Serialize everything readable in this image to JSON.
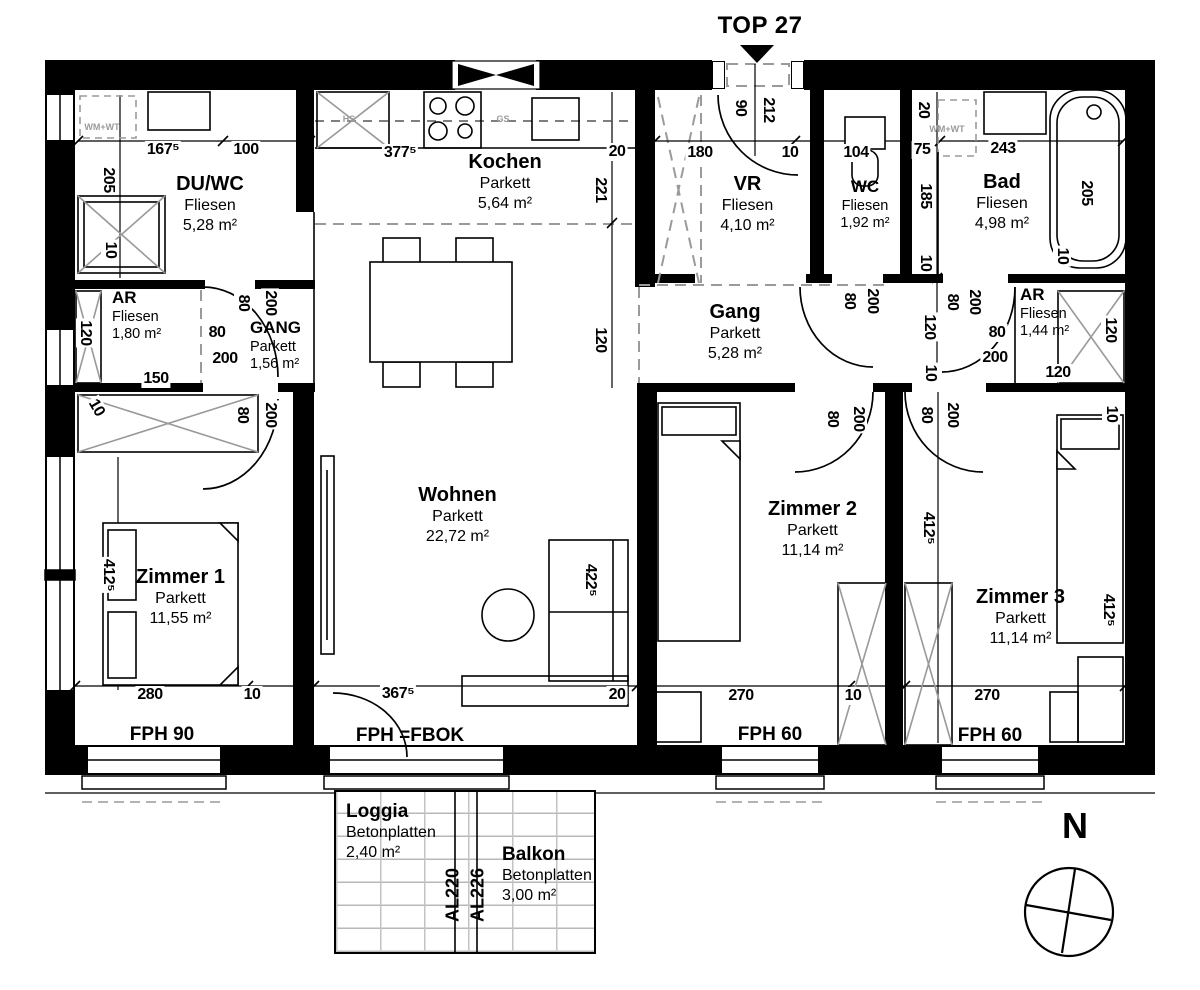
{
  "title": "TOP 27",
  "compass": {
    "label": "N"
  },
  "colors": {
    "wall": "#000000",
    "dash_gray": "#9a9a9a",
    "furniture_gray": "#999999"
  },
  "rooms": [
    {
      "name": "DU/WC",
      "floor": "Fliesen",
      "area": "5,28 m²"
    },
    {
      "name": "Kochen",
      "floor": "Parkett",
      "area": "5,64 m²"
    },
    {
      "name": "VR",
      "floor": "Fliesen",
      "area": "4,10 m²"
    },
    {
      "name": "WC",
      "floor": "Fliesen",
      "area": "1,92 m²"
    },
    {
      "name": "Bad",
      "floor": "Fliesen",
      "area": "4,98 m²"
    },
    {
      "name": "AR",
      "floor": "Fliesen",
      "area": "1,80 m²"
    },
    {
      "name": "GANG",
      "floor": "Parkett",
      "area": "1,56 m²"
    },
    {
      "name": "Gang",
      "floor": "Parkett",
      "area": "5,28 m²"
    },
    {
      "name": "AR",
      "floor": "Fliesen",
      "area": "1,44 m²"
    },
    {
      "name": "Wohnen",
      "floor": "Parkett",
      "area": "22,72 m²"
    },
    {
      "name": "Zimmer 1",
      "floor": "Parkett",
      "area": "11,55 m²"
    },
    {
      "name": "Zimmer 2",
      "floor": "Parkett",
      "area": "11,14 m²"
    },
    {
      "name": "Zimmer 3",
      "floor": "Parkett",
      "area": "11,14 m²"
    },
    {
      "name": "Loggia",
      "floor": "Betonplatten",
      "area": "2,40 m²"
    },
    {
      "name": "Balkon",
      "floor": "Betonplatten",
      "area": "3,00 m²"
    }
  ],
  "annotations": [
    {
      "t": "167⁵",
      "x": 163,
      "y": 150,
      "k": "dim"
    },
    {
      "t": "100",
      "x": 246,
      "y": 150,
      "k": "dim"
    },
    {
      "t": "377⁵",
      "x": 400,
      "y": 153,
      "k": "dim"
    },
    {
      "t": "20",
      "x": 617,
      "y": 152,
      "k": "dim"
    },
    {
      "t": "180",
      "x": 700,
      "y": 153,
      "k": "dim"
    },
    {
      "t": "10",
      "x": 790,
      "y": 153,
      "k": "dim"
    },
    {
      "t": "104",
      "x": 856,
      "y": 153,
      "k": "dim"
    },
    {
      "t": "243",
      "x": 1003,
      "y": 149,
      "k": "dim"
    },
    {
      "t": "75",
      "x": 922,
      "y": 150,
      "k": "dim"
    },
    {
      "t": "90",
      "x": 740,
      "y": 108,
      "r": 90,
      "k": "dim"
    },
    {
      "t": "212",
      "x": 768,
      "y": 110,
      "r": 90,
      "k": "dim"
    },
    {
      "t": "205",
      "x": 108,
      "y": 180,
      "r": 90,
      "k": "dim"
    },
    {
      "t": "10",
      "x": 110,
      "y": 250,
      "r": 90,
      "k": "dim"
    },
    {
      "t": "221",
      "x": 600,
      "y": 190,
      "r": 90,
      "k": "dim"
    },
    {
      "t": "120",
      "x": 600,
      "y": 340,
      "r": 90,
      "k": "dim"
    },
    {
      "t": "20",
      "x": 923,
      "y": 110,
      "r": 90,
      "k": "dim"
    },
    {
      "t": "185",
      "x": 925,
      "y": 196,
      "r": 90,
      "k": "dim"
    },
    {
      "t": "10",
      "x": 925,
      "y": 263,
      "r": 90,
      "k": "dim"
    },
    {
      "t": "205",
      "x": 1086,
      "y": 193,
      "r": 90,
      "k": "dim"
    },
    {
      "t": "10",
      "x": 1062,
      "y": 256,
      "r": 90,
      "k": "dim"
    },
    {
      "t": "120",
      "x": 85,
      "y": 333,
      "r": 90,
      "k": "dim"
    },
    {
      "t": "150",
      "x": 156,
      "y": 379,
      "k": "dim"
    },
    {
      "t": "10",
      "x": 96,
      "y": 408,
      "r": 60,
      "k": "dim"
    },
    {
      "t": "80",
      "x": 243,
      "y": 303,
      "r": 90,
      "k": "dim"
    },
    {
      "t": "200",
      "x": 270,
      "y": 303,
      "r": 90,
      "k": "dim"
    },
    {
      "t": "80",
      "x": 217,
      "y": 333,
      "k": "dim"
    },
    {
      "t": "200",
      "x": 225,
      "y": 359,
      "k": "dim"
    },
    {
      "t": "80",
      "x": 242,
      "y": 415,
      "r": 90,
      "k": "dim"
    },
    {
      "t": "200",
      "x": 270,
      "y": 415,
      "r": 90,
      "k": "dim"
    },
    {
      "t": "422⁵",
      "x": 590,
      "y": 580,
      "r": 90,
      "k": "dim"
    },
    {
      "t": "412⁵",
      "x": 108,
      "y": 575,
      "r": 90,
      "k": "dim"
    },
    {
      "t": "280",
      "x": 150,
      "y": 695,
      "k": "dim"
    },
    {
      "t": "10",
      "x": 252,
      "y": 695,
      "k": "dim"
    },
    {
      "t": "367⁵",
      "x": 398,
      "y": 694,
      "k": "dim"
    },
    {
      "t": "20",
      "x": 617,
      "y": 695,
      "k": "dim"
    },
    {
      "t": "270",
      "x": 741,
      "y": 696,
      "k": "dim"
    },
    {
      "t": "10",
      "x": 853,
      "y": 696,
      "k": "dim"
    },
    {
      "t": "270",
      "x": 987,
      "y": 696,
      "k": "dim"
    },
    {
      "t": "80",
      "x": 849,
      "y": 301,
      "r": 90,
      "k": "dim"
    },
    {
      "t": "200",
      "x": 872,
      "y": 301,
      "r": 90,
      "k": "dim"
    },
    {
      "t": "120",
      "x": 929,
      "y": 327,
      "r": 90,
      "k": "dim"
    },
    {
      "t": "10",
      "x": 930,
      "y": 373,
      "r": 90,
      "k": "dim"
    },
    {
      "t": "80",
      "x": 952,
      "y": 302,
      "r": 90,
      "k": "dim"
    },
    {
      "t": "200",
      "x": 974,
      "y": 302,
      "r": 90,
      "k": "dim"
    },
    {
      "t": "80",
      "x": 997,
      "y": 333,
      "k": "dim"
    },
    {
      "t": "200",
      "x": 995,
      "y": 358,
      "k": "dim"
    },
    {
      "t": "120",
      "x": 1058,
      "y": 373,
      "k": "dim"
    },
    {
      "t": "120",
      "x": 1110,
      "y": 330,
      "r": 90,
      "k": "dim"
    },
    {
      "t": "10",
      "x": 1111,
      "y": 414,
      "r": 90,
      "k": "dim"
    },
    {
      "t": "80",
      "x": 832,
      "y": 419,
      "r": 90,
      "k": "dim"
    },
    {
      "t": "200",
      "x": 858,
      "y": 419,
      "r": 90,
      "k": "dim"
    },
    {
      "t": "80",
      "x": 926,
      "y": 415,
      "r": 90,
      "k": "dim"
    },
    {
      "t": "200",
      "x": 952,
      "y": 415,
      "r": 90,
      "k": "dim"
    },
    {
      "t": "412⁵",
      "x": 928,
      "y": 528,
      "r": 90,
      "k": "dim"
    },
    {
      "t": "412⁵",
      "x": 1108,
      "y": 610,
      "r": 90,
      "k": "dim"
    },
    {
      "t": "FPH 90",
      "x": 162,
      "y": 735,
      "k": "win"
    },
    {
      "t": "FPH =FBOK",
      "x": 410,
      "y": 736,
      "k": "win"
    },
    {
      "t": "FPH 60",
      "x": 770,
      "y": 735,
      "k": "win"
    },
    {
      "t": "FPH 60",
      "x": 990,
      "y": 736,
      "k": "win"
    },
    {
      "t": "WM+WT",
      "x": 102,
      "y": 127,
      "k": "app"
    },
    {
      "t": "HS",
      "x": 349,
      "y": 119,
      "k": "app"
    },
    {
      "t": "GS",
      "x": 503,
      "y": 119,
      "k": "app"
    },
    {
      "t": "WM+WT",
      "x": 947,
      "y": 129,
      "k": "app"
    },
    {
      "t": "AL220",
      "x": 453,
      "y": 895,
      "r": -90,
      "k": "bal"
    },
    {
      "t": "AL226",
      "x": 478,
      "y": 895,
      "r": -90,
      "k": "bal"
    }
  ]
}
